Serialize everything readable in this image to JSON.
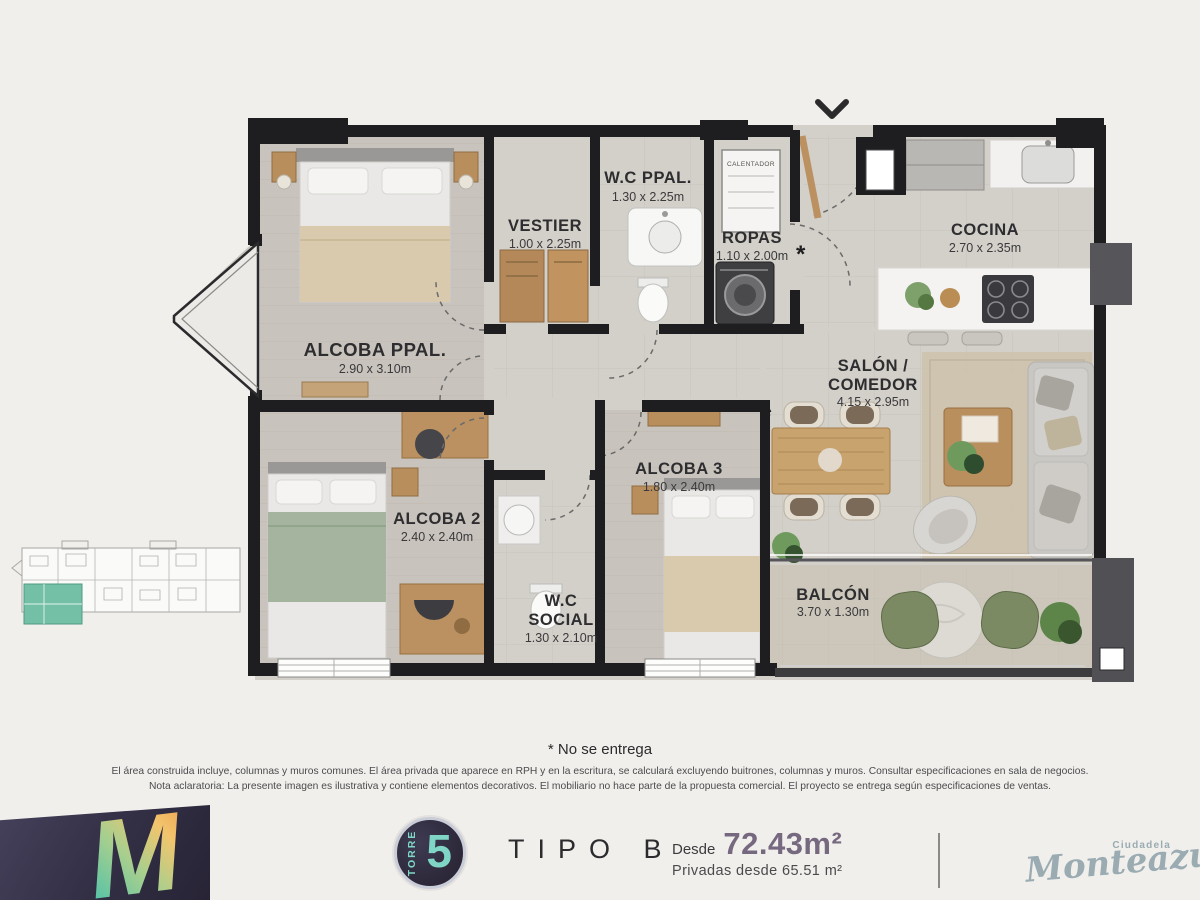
{
  "plan": {
    "asterisk": "*",
    "calentador": "CALENTADOR",
    "rooms": {
      "wc_ppal": {
        "name": "W.C PPAL.",
        "dims": "1.30 x 2.25m"
      },
      "vestier": {
        "name": "VESTIER",
        "dims": "1.00 x 2.25m"
      },
      "ropas": {
        "name": "ROPAS",
        "dims": "1.10 x 2.00m"
      },
      "cocina": {
        "name": "COCINA",
        "dims": "2.70 x 2.35m"
      },
      "alcoba_ppal": {
        "name": "ALCOBA PPAL.",
        "dims": "2.90 x 3.10m"
      },
      "salon": {
        "line1": "SALÓN /",
        "line2": "COMEDOR",
        "dims": "4.15 x 2.95m"
      },
      "alcoba3": {
        "name": "ALCOBA 3",
        "dims": "1.80 x 2.40m"
      },
      "alcoba2": {
        "name": "ALCOBA 2",
        "dims": "2.40 x 2.40m"
      },
      "wc_social": {
        "line1": "W.C",
        "line2": "SOCIAL",
        "dims": "1.30 x 2.10m"
      },
      "balcon": {
        "name": "BALCÓN",
        "dims": "3.70 x 1.30m"
      }
    }
  },
  "notes": {
    "no_entrega": "* No se entrega",
    "disclaimer1": "El área construida incluye, columnas y muros comunes. El área privada que aparece en RPH y en la escritura, se calculará excluyendo buitrones, columnas y muros. Consultar especificaciones en sala de negocios.",
    "disclaimer2": "Nota aclaratoria: La presente imagen es ilustrativa y contiene elementos decorativos. El mobiliario no hace parte de la propuesta comercial. El proyecto se entrega según especificaciones de ventas."
  },
  "footer": {
    "logo_letter": "M",
    "tower_word": "TORRE",
    "tower_number": "5",
    "type_label": "TIPO B",
    "area_prefix": "Desde",
    "area_value": "72.43m²",
    "private_area": "Privadas desde 65.51 m²",
    "brand_small": "Ciudadela",
    "brand_name": "Monteazul"
  },
  "colors": {
    "teal_accent": "#7fd6c6",
    "badge_bg": "#322e3d",
    "area_value_color": "#75687f",
    "brand_color": "#9aabb2",
    "keyplan_highlight": "#73c0a6",
    "wall": "#1e1e20"
  }
}
